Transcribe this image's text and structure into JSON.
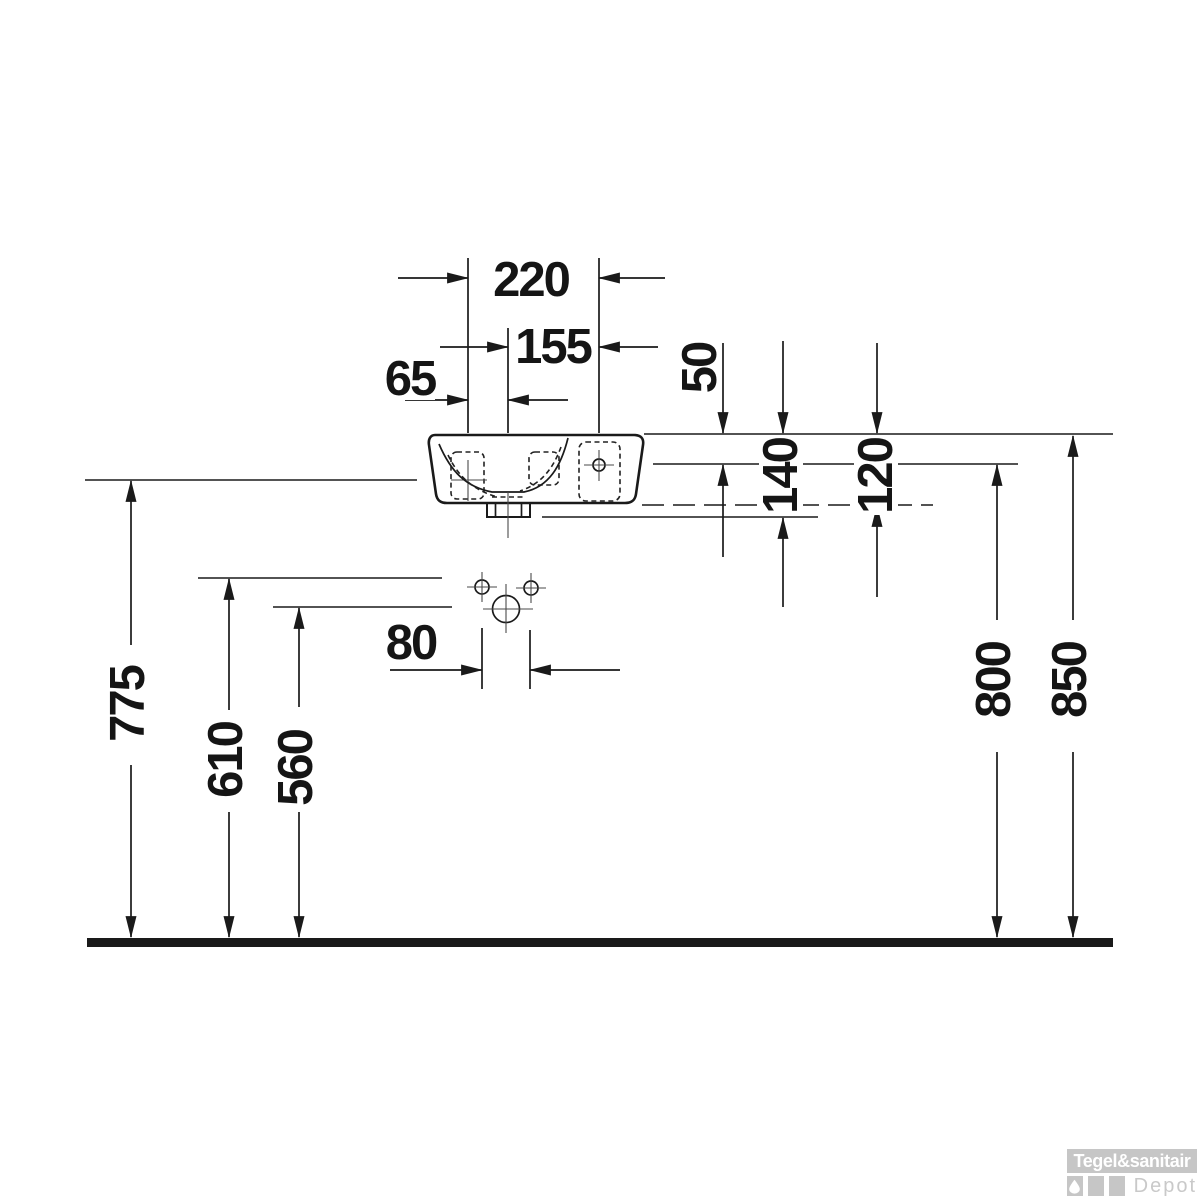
{
  "drawing": {
    "type": "technical-dimension-drawing",
    "view": "washbasin front view with mounting and drain positions",
    "unit_note": "",
    "dims": {
      "d220": "220",
      "d155": "155",
      "d65": "65",
      "d50": "50",
      "d140": "140",
      "d120": "120",
      "d80": "80",
      "d775": "775",
      "d610": "610",
      "d560": "560",
      "d800": "800",
      "d850": "850"
    }
  },
  "watermark": {
    "brand": "Tegel&sanitair",
    "sub": "Depot"
  },
  "colors": {
    "ink": "#1a1a1a",
    "watermark_gray": "#c6c6c6",
    "background": "#ffffff"
  }
}
